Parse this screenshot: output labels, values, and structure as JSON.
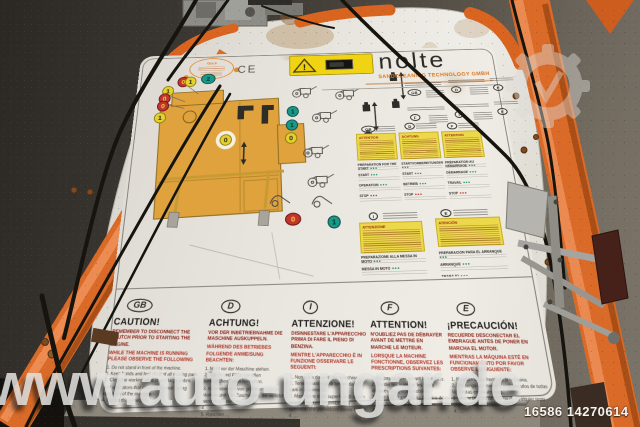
{
  "watermark": {
    "url_text": "www.auto-ungar.de",
    "listing_id": "16586 14270614"
  },
  "label": {
    "brand": "nolte",
    "subtitle": "SANDCLEANING TECHNOLOGY GMBH",
    "ce_mark": "CE",
    "badge_text": "GOLF",
    "warning_symbol": "!",
    "marks": [
      "0",
      "1",
      "2",
      "1",
      "0",
      "0",
      "1",
      "1",
      "1",
      "0",
      "0",
      "0",
      "1"
    ]
  },
  "panel": {
    "codes": [
      "GB",
      "D",
      "E",
      "F",
      "I",
      "E",
      "GB",
      "D",
      "F",
      "I",
      "E"
    ],
    "warn_headers": [
      "ATTENTION",
      "ACHTUNG",
      "ATTENTION"
    ],
    "warn_header_it": "ATTENZIONE",
    "warn_header_es": "ATENCIÓN",
    "sections_en": [
      "PREPARATION FOR THE START",
      "START",
      "OPERATION",
      "STOP"
    ],
    "sections_de": [
      "STARTVORBEREITUNGEN",
      "START",
      "BETRIEB",
      "STOP"
    ],
    "sections_fr": [
      "PRÉPARATION AU DÉMARRAGE",
      "DÉMARRAGE",
      "TRAVAIL",
      "STOP"
    ],
    "sections_it": [
      "PREPARAZIONE ALLA MESSA IN MOTO",
      "MESSA IN MOTO",
      "FUNZIONAMENTO",
      "STOP"
    ],
    "sections_es": [
      "PREPARACIÓN PARA EL ARRANQUE",
      "ARRANQUE",
      "TRABAJO",
      "PARADA"
    ]
  },
  "warnings": {
    "columns": [
      {
        "code": "GB",
        "title": "CAUTION!",
        "subtitle": "REMEMBER TO DISCONNECT THE CLUTCH PRIOR TO STARTING THE ENGINE.",
        "notice": "WHILE THE MACHINE IS RUNNING PLEASE OBSERVE THE FOLLOWING",
        "items": "1. Do not stand in front of the machine.\n2. Keep hands and feet clear of all moving parts.\n3. Clear the working area of any large debris and spectators that could be injured during operation of the machine.\n4. Do not disconnect the …"
      },
      {
        "code": "D",
        "title": "ACHTUNG!",
        "subtitle": "VOR DER INBETRIEBNAHME DIE MASCHINE AUSKUPPELN.",
        "notice": "WÄHREND DES BETRIEBES FOLGENDE ANWEISUNG BEACHTEN:",
        "items": "1. Nicht vor der Maschine stehen.\n2. Hände und Füße von allen beweglichen Teilen fernhalten.\n3. Arbeitsbereich von größerem Schutt räumen und von Zuschauern, die verletzt werden könnten, freihalten.\n4. …\n5. Rauchen …"
      },
      {
        "code": "I",
        "title": "ATTENZIONE!",
        "subtitle": "DISINNESTARE L'APPARECCHIO PRIMA DI FARE IL PIENO DI BENZINA.",
        "notice": "MENTRE L'APPARECCHIO È IN FUNZIONE OSSERVARE LE SEGUENTI:",
        "items": "1. Non stare davanti alla macchina.\n2. Tenere mani e piedi lontani dalle parti in movimento.\n3. Mantenere dalla superficie di lavoro eventuali oggetti ingombranti e spettatori che potrebbero venire feriti.\n4. …"
      },
      {
        "code": "F",
        "title": "ATTENTION!",
        "subtitle": "N'OUBLIEZ PAS DE DÉBRAYER AVANT DE METTRE EN MARCHE LE MOTEUR.",
        "notice": "LORSQUE LA MACHINE FONCTIONNE, OBSERVEZ LES PRESCRIPTIONS SUIVANTES:",
        "items": "1. Ne pas se tenir devant la machine.\n2. Garder les mains et les pieds éloignés des pièces mobiles.\n3. Ôter tout grand débris de l'aire de travail pour éviter des blessures.\n4. …"
      },
      {
        "code": "E",
        "title": "¡PRECAUCIÓN!",
        "subtitle": "RECUERDE DESCONECTAR EL EMBRAGUE ANTES DE PONER EN MARCHA EL MOTOR.",
        "notice": "MIENTRAS LA MÁQUINA ESTÉ EN FUNCIONAMIENTO POR FAVOR OBSERVE LO SIGUIENTE:",
        "items": "1. No situarse en frente de la máquina.\n2. Mantenga las manos y pies alejados de todas las piezas en movimiento.\n3. Limpie la zona de trabajo de cualquier resto grande y espectadores.\n4. …"
      }
    ]
  }
}
